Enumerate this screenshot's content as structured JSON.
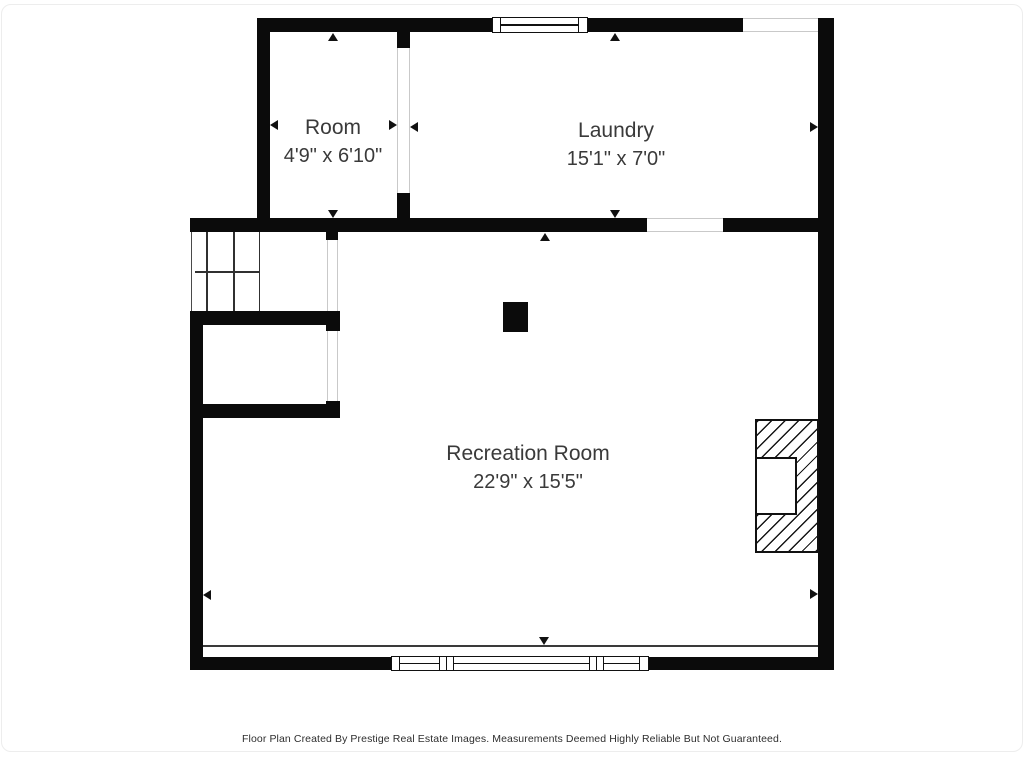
{
  "title": "Basement Floor Plan",
  "rooms": [
    {
      "name": "Room",
      "dimensions": "4'9\" x 6'10\""
    },
    {
      "name": "Laundry",
      "dimensions": "15'1\" x 7'0\""
    },
    {
      "name": "Recreation Room",
      "dimensions": "22'9\" x 15'5\""
    }
  ],
  "features": [
    {
      "name": "staircase"
    },
    {
      "name": "under-stair-closet"
    },
    {
      "name": "fireplace"
    },
    {
      "name": "support-post"
    },
    {
      "name": "top-window"
    },
    {
      "name": "bottom-window-assembly"
    },
    {
      "name": "dimension-arrows"
    }
  ],
  "colors": {
    "wall": "#0b0b0b",
    "label_text": "#3a3a3a",
    "opening_line": "#c9c9c9",
    "background": "#ffffff"
  },
  "footer": {
    "text": "Floor Plan Created By Prestige Real Estate Images. Measurements Deemed Highly Reliable But Not Guaranteed."
  }
}
